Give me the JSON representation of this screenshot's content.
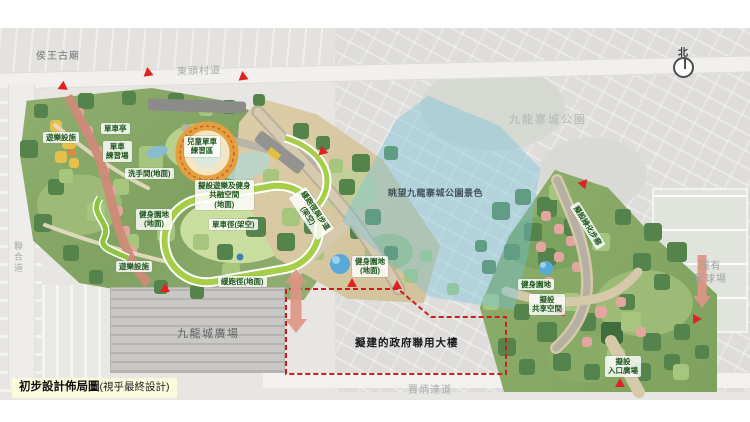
{
  "title": {
    "main": "初步設計佈局圖",
    "note": "(視乎最終設計)"
  },
  "compass": {
    "north": "北"
  },
  "context": {
    "temple": "侯王古廟",
    "road_tung_tau_tsuen": "東頭村道",
    "road_junction": "聯合道",
    "road_carpenter": "賈炳達道",
    "walled_city_park": "九龍寨城公園",
    "kcp_plaza": "九龍城廣場",
    "football_ground": "現有\n足球場"
  },
  "annotations": {
    "view_corridor": "眺望九龍寨城公園景色",
    "gov_building": "擬建的政府聯用大樓"
  },
  "facilities": [
    {
      "text": "遊樂設施"
    },
    {
      "text": "單車亭"
    },
    {
      "text": "單車\n練習場"
    },
    {
      "text": "兒童單車\n練習區"
    },
    {
      "text": "洗手間(地面)"
    },
    {
      "text": "擬設遊樂及健身\n共融空間\n(地面)"
    },
    {
      "text": "健身園地\n(地面)"
    },
    {
      "text": "單車徑(架空)"
    },
    {
      "text": "遊樂設施"
    },
    {
      "text": "緩跑徑(地面)"
    },
    {
      "text": "緩跑徑與步道\n(架空)"
    },
    {
      "text": "健身園地\n(地面)"
    },
    {
      "text": "擬設綠化步廊"
    },
    {
      "text": "健身園地"
    },
    {
      "text": "擬設\n共享空間"
    },
    {
      "text": "擬設\n入口廣場"
    }
  ],
  "colors": {
    "entrance_marker_red": "#e02222",
    "boundary_red": "#cf1d1d",
    "view_cone_blue": "#72c4dd",
    "cycle_track_green": "#a6ce46",
    "promenade_salmon": "#cc8b78",
    "facility_label_green": "#1d571d"
  }
}
